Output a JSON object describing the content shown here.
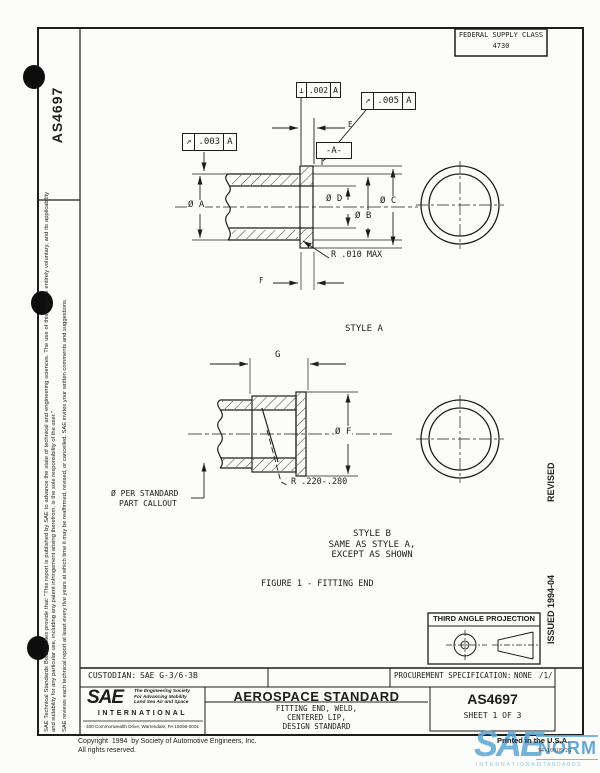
{
  "sheet": {
    "federal_supply_class": {
      "label": "FEDERAL SUPPLY CLASS",
      "value": "4730"
    },
    "left_margin": {
      "doc_number": "AS4697",
      "disclaimer_1": "SAE Technical Standards Board Rules provide that: \"This report is published by SAE to advance the state of technical and engineering sciences. The use of this report is entirely voluntary, and its applicability and suitability for any particular use, including any patent infringement arising therefrom, is the sole responsibility of the user.\"",
      "disclaimer_2": "SAE reviews each technical report at least every five years at which time it may be reaffirmed, revised, or cancelled.  SAE invites your written comments and suggestions."
    },
    "right_margin": {
      "revised": "REVISED",
      "issued": "ISSUED  1994-04"
    }
  },
  "drawing": {
    "fcf_perpendicularity": {
      "symbol": "⊥",
      "tolerance": ".002",
      "datum": "A"
    },
    "fcf_runout_upper": {
      "symbol": "↗",
      "tolerance": ".005",
      "datum": "A"
    },
    "fcf_runout_lower": {
      "symbol": "↗",
      "tolerance": ".003",
      "datum": "A"
    },
    "datum_flag": "-A-",
    "dims": {
      "dia_a": "Ø A",
      "dia_b": "Ø B",
      "dia_c": "Ø C",
      "dia_d": "Ø D",
      "dim_e": "E",
      "dim_f": "F",
      "dim_g": "G",
      "dia_f": "Ø F"
    },
    "notes": {
      "radius_max": "R .010 MAX",
      "radius_range": "R .220-.280",
      "per_standard_1": "Ø PER STANDARD",
      "per_standard_2": "PART CALLOUT"
    },
    "captions": {
      "style_a": "STYLE A",
      "style_b_1": "STYLE B",
      "style_b_2": "SAME AS STYLE A,",
      "style_b_3": "EXCEPT AS SHOWN",
      "figure": "FIGURE 1 - FITTING END"
    }
  },
  "projection": {
    "title": "THIRD ANGLE PROJECTION"
  },
  "title_block": {
    "custodian_label": "CUSTODIAN:",
    "custodian_value": "SAE G-3/6-3B",
    "procurement_label": "PROCUREMENT SPECIFICATION:",
    "procurement_value": "NONE",
    "procurement_note": "/1/",
    "standard_type": "AEROSPACE STANDARD",
    "title_line_1": "FITTING END, WELD,",
    "title_line_2": "CENTERED LIP,",
    "title_line_3": "DESIGN STANDARD",
    "doc_number": "AS4697",
    "sheet": "SHEET 1 OF 3"
  },
  "sae_logo": {
    "name": "SAE",
    "tagline_1": "The Engineering Society",
    "tagline_2": "For Advancing Mobility",
    "tagline_3": "Land Sea Air and Space",
    "international": "INTERNATIONAL",
    "address": "400 Commonwealth Drive, Warrendale, PA 15096-0001"
  },
  "footer": {
    "copyright": "Copyright  1994  by Society of Automotive Engineers, Inc.",
    "rights": "All rights reserved.",
    "printed": "Printed in the U.S.A.",
    "doc_code": "94-1001B/2G"
  },
  "watermark": {
    "sae": "SAE",
    "norm": "NORM",
    "international": "INTERNATIONAL",
    "standards": "STANDARDS",
    "color": "#5aa7d6"
  }
}
